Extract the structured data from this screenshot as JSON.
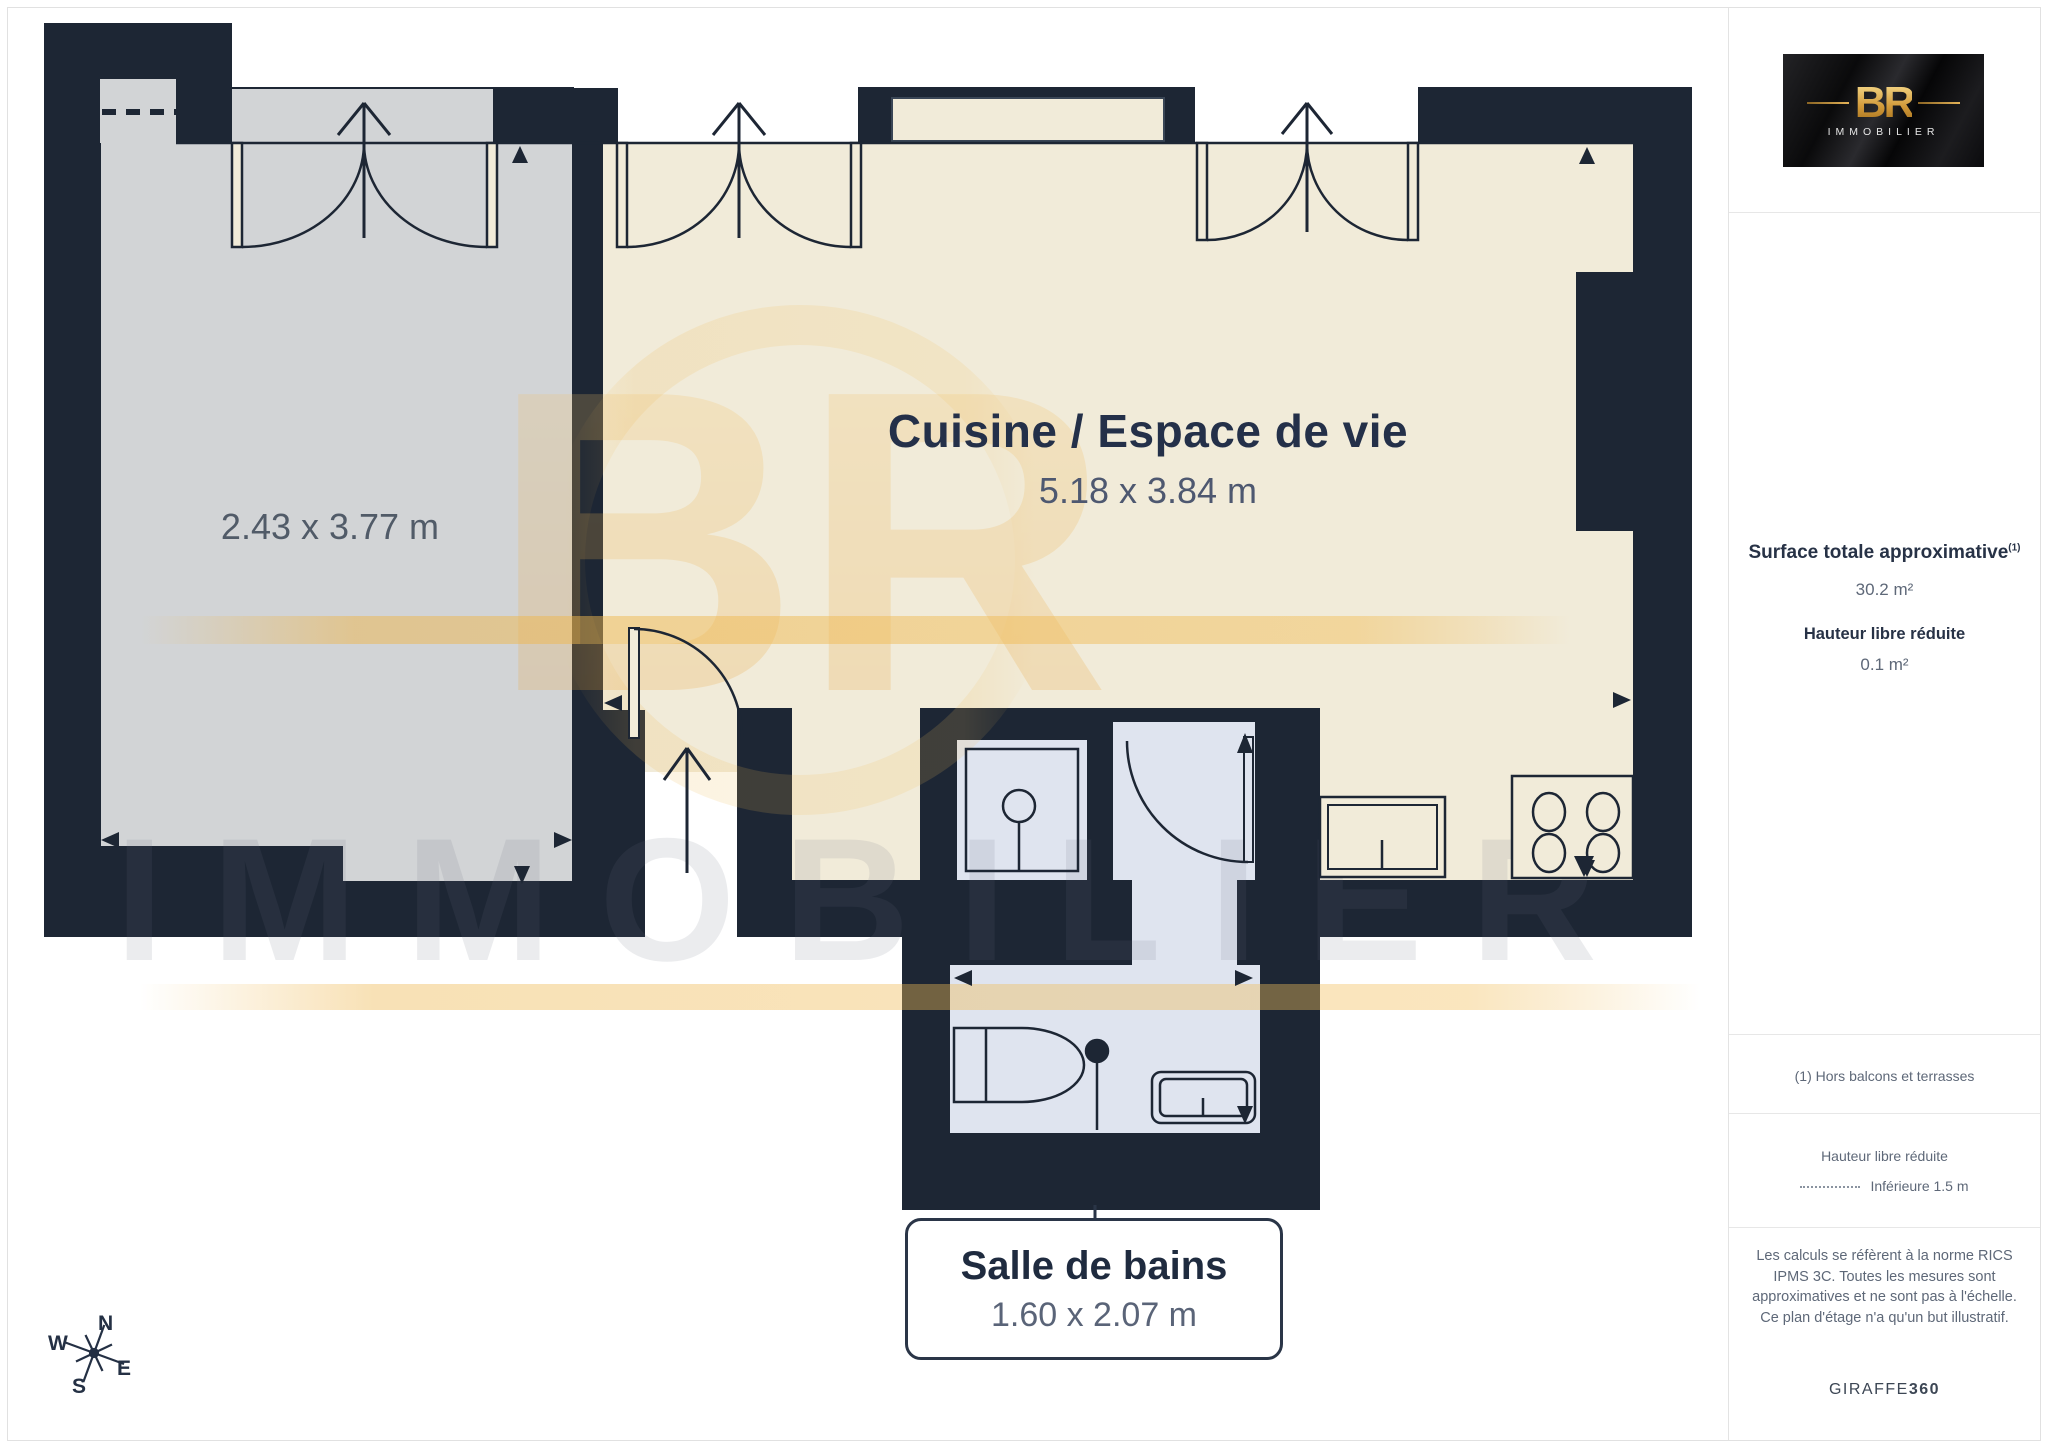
{
  "plan": {
    "rooms": {
      "terrace": {
        "dims": "2.43 x 3.77 m"
      },
      "living": {
        "name": "Cuisine / Espace de vie",
        "dims": "5.18 x 3.84 m"
      },
      "bathroom": {
        "name": "Salle de bains",
        "dims": "1.60 x 2.07 m"
      }
    },
    "compass": {
      "n": "N",
      "s": "S",
      "e": "E",
      "w": "W"
    }
  },
  "watermark": {
    "monogram": "BR",
    "text": "IMMOBILIER"
  },
  "sidebar": {
    "logo": {
      "monogram": "BR",
      "brand": "IMMOBILIER"
    },
    "surface_title": "Surface totale approximative",
    "surface_sup": "(1)",
    "surface_value": "30.2 m²",
    "reduced_title": "Hauteur libre réduite",
    "reduced_value": "0.1 m²",
    "footnote": "(1) Hors balcons et terrasses",
    "legend_title": "Hauteur libre réduite",
    "legend_value": "Inférieure 1.5 m",
    "disclaimer": "Les calculs se réfèrent à la norme RICS IPMS 3C. Toutes les mesures sont approximatives et ne sont pas à l'échelle. Ce plan d'étage n'a qu'un but illustratif.",
    "footer_brand_regular": "GIRAFFE",
    "footer_brand_bold": "360"
  },
  "colors": {
    "wall": "#1d2634",
    "living_floor": "#f1ebd9",
    "terrace_floor": "#d2d4d6",
    "bath_floor": "#dfe4ef",
    "gold": "#e9b44c",
    "title_text": "#243049"
  }
}
